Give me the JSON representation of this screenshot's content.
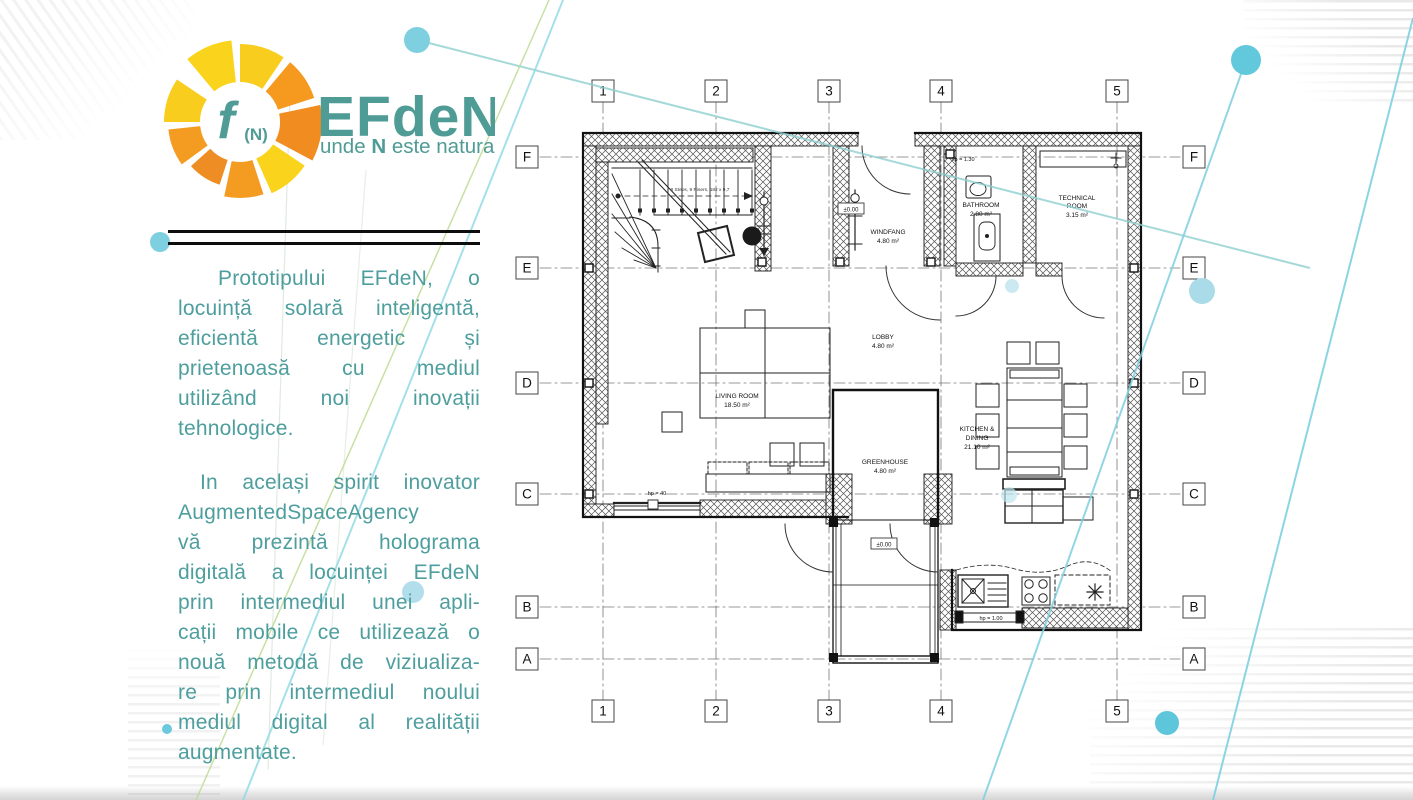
{
  "logo": {
    "f": "f",
    "n_paren": "(N)",
    "title": "EFdeN",
    "tagline_pre": "unde ",
    "tagline_bold": "N",
    "tagline_post": " este natura"
  },
  "intro": {
    "p1_lines": [
      "Prototipului EFdeN, o",
      "locuință solară inteligentă,",
      "eficientă energetic și",
      "prietenoasă cu mediul",
      "utilizând noi inovații",
      "tehnologice."
    ],
    "p2_lines": [
      "In același spirit inovator",
      "AugmentedSpaceAgency",
      "vă prezintă holograma",
      "digitală a locuinței EFdeN",
      "prin intermediul unei apli-",
      "cații mobile ce utilizează o",
      "nouă metodă de viziualiza-",
      "re prin intermediul noului",
      "mediul digital al realității",
      "augmentate."
    ]
  },
  "plan": {
    "grid_columns": [
      "1",
      "2",
      "3",
      "4",
      "5"
    ],
    "grid_rows": [
      "F",
      "E",
      "D",
      "C",
      "B",
      "A"
    ],
    "rooms": {
      "windfang": {
        "line1": "WINDFANG",
        "line2": "4.80 m²"
      },
      "bathroom": {
        "line1": "BATHROOM",
        "line2": "2.80 m²"
      },
      "technical": {
        "line1": "TECHNICAL",
        "line2": "ROOM",
        "line3": "3.15 m²"
      },
      "lobby": {
        "line1": "LOBBY",
        "line2": "4.80 m²"
      },
      "living": {
        "line1": "LIVING ROOM",
        "line2": "18.50 m²"
      },
      "kitchen": {
        "line1": "KITCHEN &",
        "line2": "DINING",
        "line3": "21.10 m²"
      },
      "greenhouse": {
        "line1": "GREENHOUSE",
        "line2": "4.80 m²"
      }
    },
    "levels": [
      "±0.00",
      "±0.00"
    ],
    "annotations": {
      "hp130": "hp = 1.30",
      "hp40": "hp = 40",
      "hp100": "hp = 1.00"
    },
    "stair_note": "8 Steps, 9 Risers, 182 x 9,7"
  },
  "colors": {
    "teal_text": "#4E9E9E",
    "logo_teal": "#4F9B95",
    "petal_orange": "#F18C20",
    "petal_yellow": "#FAD41C",
    "decor_cyan": "#7ECFE0",
    "decor_green": "#B9D98E"
  }
}
